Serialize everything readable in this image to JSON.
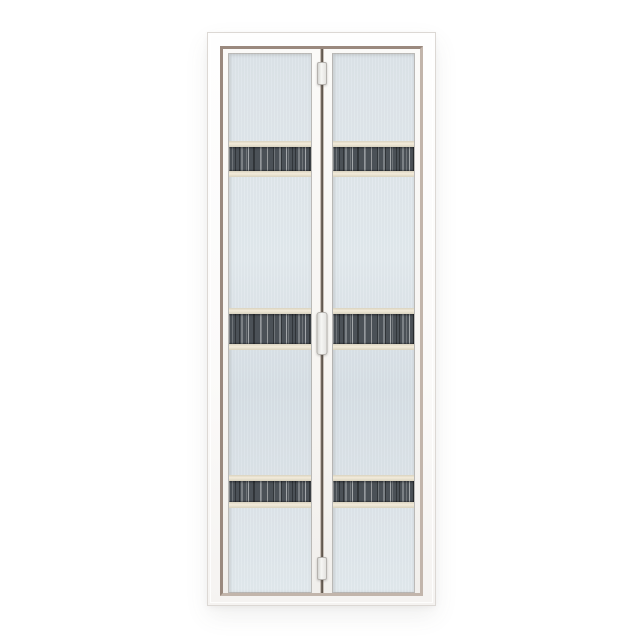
{
  "scene": {
    "type": "product-photo",
    "subject": "White aluminium bi-fold door with two frosted glass leaves and dark woodgrain accent strips"
  },
  "colors": {
    "background": "#ffffff",
    "frame_white": "#fbfaf9",
    "frame_outline": "#dcd8d4",
    "reveal_taupe_dark": "#9a897e",
    "reveal_taupe_light": "#c2b5ab",
    "leaf_white": "#f8f6f4",
    "glass_base": "#dde5ea",
    "glass_light": "#e3eaee",
    "glass_deep": "#d7e0e6",
    "band_cream": "#f2ebda",
    "band_cream_edge": "#d9d2bf",
    "strip_dark": "#4b5157",
    "divider_dark": "#3a332d",
    "hardware_white": "#f6f6f4",
    "hardware_edge": "#b5b2ae"
  },
  "door": {
    "leaf_count": 2,
    "accent_strips": [
      {
        "top": 87,
        "height": 36
      },
      {
        "top": 254,
        "height": 42
      },
      {
        "top": 421,
        "height": 33
      }
    ],
    "hardware": [
      {
        "name": "top-pivot-hinge",
        "top": 29,
        "height": 21
      },
      {
        "name": "fold-handle",
        "top": 279,
        "height": 41
      },
      {
        "name": "bottom-pivot-hinge",
        "top": 524,
        "height": 21
      }
    ]
  }
}
